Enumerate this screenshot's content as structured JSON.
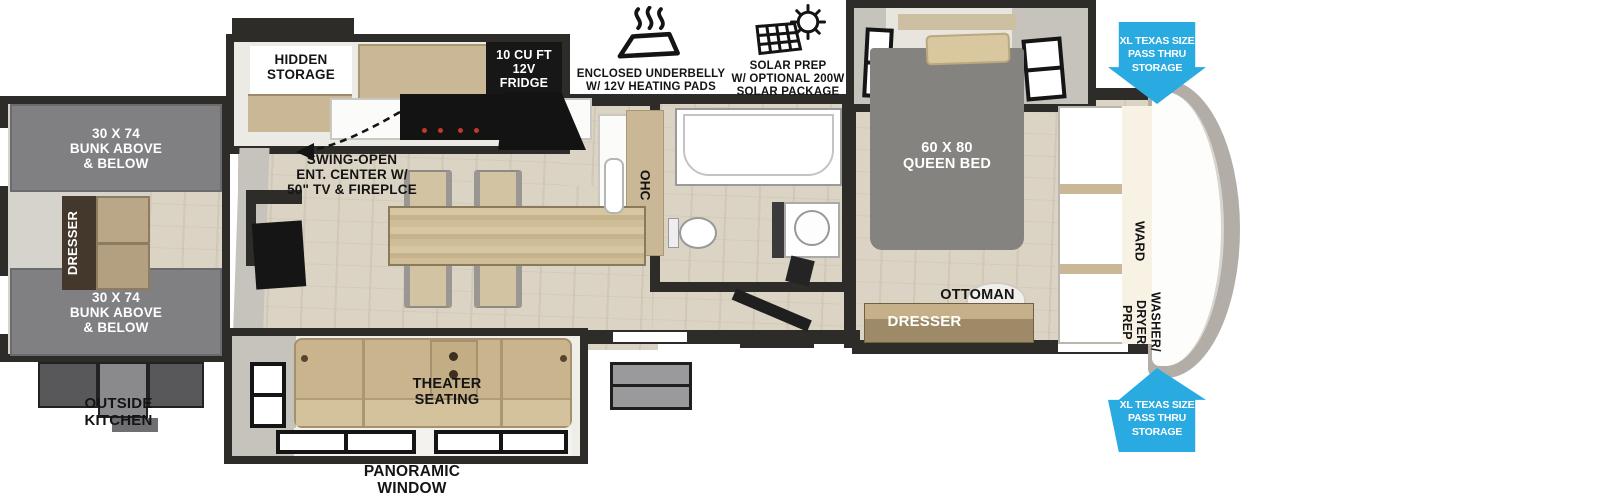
{
  "annotations": {
    "underbelly": "ENCLOSED UNDERBELLY\nW/ 12V HEATING PADS",
    "solar": "SOLAR PREP\nW/ OPTIONAL 200W\nSOLAR PACKAGE",
    "pass_thru_top": "XL TEXAS SIZE\nPASS THRU\nSTORAGE",
    "pass_thru_bottom": "XL TEXAS SIZE\nPASS THRU\nSTORAGE"
  },
  "rooms": {
    "hidden_storage": "HIDDEN\nSTORAGE",
    "fridge": "10 CU FT\n12V\nFRIDGE",
    "ent_center": "SWING-OPEN\nENT. CENTER W/\n50\" TV & FIREPLCE",
    "ohc": "OHC",
    "bunk_top": "30 X 74\nBUNK ABOVE\n& BELOW",
    "bunk_bottom": "30 X 74\nBUNK ABOVE\n& BELOW",
    "bunk_dresser": "DRESSER",
    "outside_kitchen": "OUTSIDE\nKITCHEN",
    "queen_bed": "60 X 80\nQUEEN BED",
    "ottoman": "OTTOMAN",
    "bedroom_dresser": "DRESSER",
    "ward": "WARD",
    "washer_dryer": "WASHER/\nDRYER\nPREP",
    "theater": "THEATER\nSEATING",
    "panoramic": "PANORAMIC\nWINDOW"
  },
  "colors": {
    "wall": "#2e2c29",
    "arrow_blue": "#29abe2",
    "floor_wood": "#dbd3c3",
    "bunk_gray": "#807f81",
    "couch_tan": "#c9b48e",
    "cabinet_tan": "#c9b795",
    "label_black": "#141414"
  }
}
